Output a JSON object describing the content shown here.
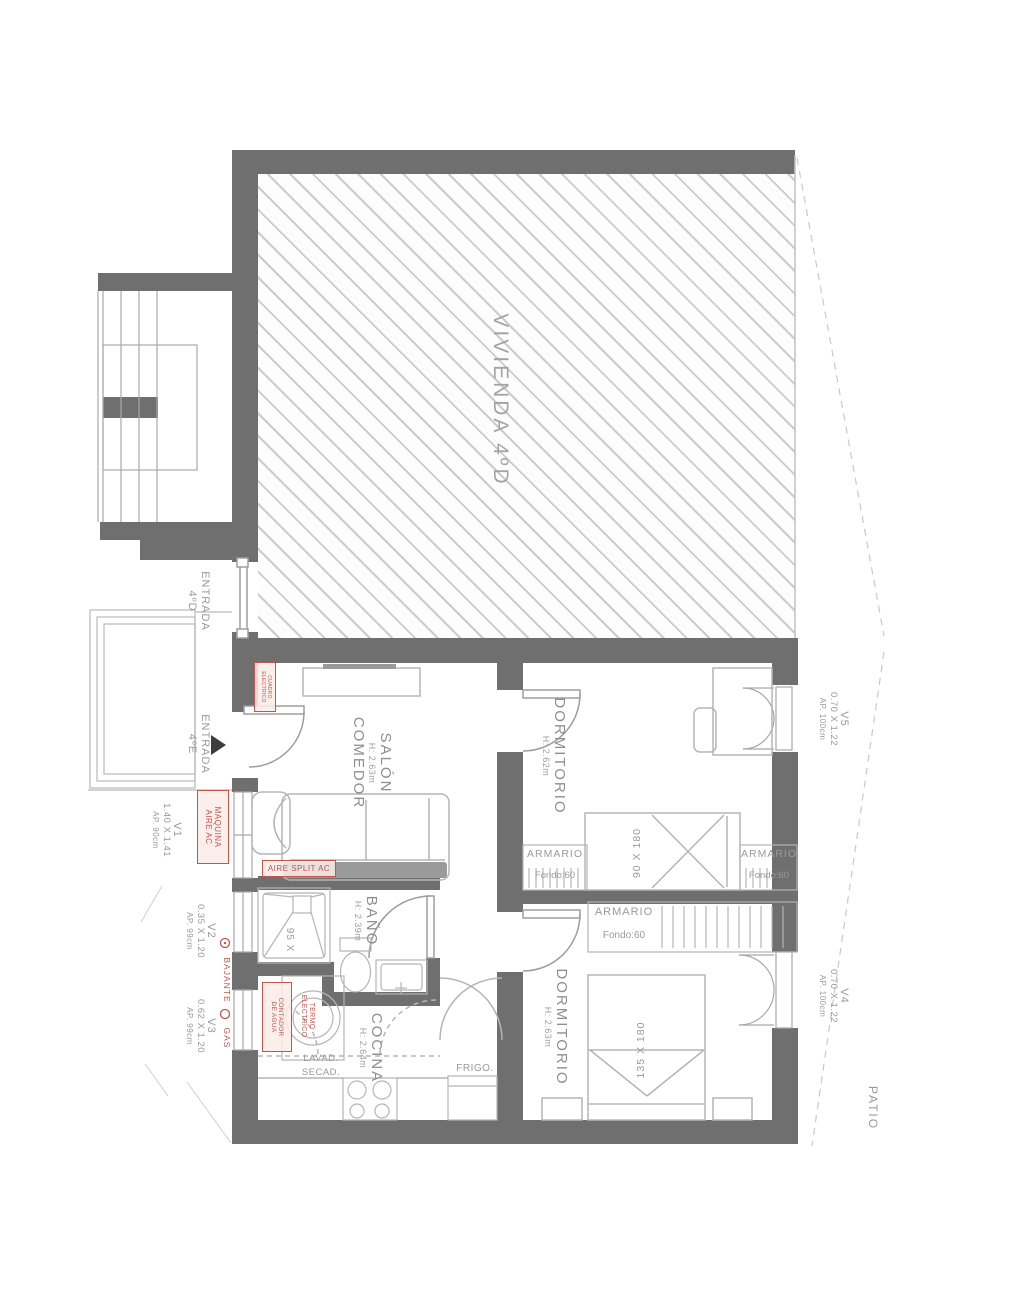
{
  "building": {
    "vivienda_label": "VIVIENDA 4ºD",
    "patio_label": "PATIO"
  },
  "entrances": {
    "d": {
      "line1": "ENTRADA",
      "line2": "4ºD"
    },
    "e": {
      "line1": "ENTRADA",
      "line2": "4ºE"
    }
  },
  "rooms": {
    "salon": {
      "line1": "SALÓN",
      "line2": "COMEDOR",
      "height": "H: 2.63m"
    },
    "dormitorio1": {
      "name": "DORMITORIO",
      "height": "H: 2.62m",
      "bed_size": "90 X 180"
    },
    "dormitorio2": {
      "name": "DORMITORIO",
      "height": "H: 2.63m",
      "bed_size": "135 X 180"
    },
    "bano": {
      "name": "BAÑO",
      "height": "H: 2.39m",
      "shower_size": "95 X"
    },
    "cocina": {
      "name": "COCINA",
      "height": "H: 2.64m"
    }
  },
  "wardrobes": {
    "bed1_left": {
      "name": "ARMARIO",
      "depth": "Fondo:60"
    },
    "bed1_right": {
      "name": "ARMARIO",
      "depth": "Fondo:60"
    },
    "bed2": {
      "name": "ARMARIO",
      "depth": "Fondo:60"
    }
  },
  "windows": {
    "v1": {
      "id": "V1",
      "size": "1.40 X 1.41",
      "sill": "AP. 90cm"
    },
    "v2": {
      "id": "V2",
      "size": "0.35 X 1.20",
      "sill": "AP. 99cm"
    },
    "v3": {
      "id": "V3",
      "size": "0.62 X 1.20",
      "sill": "AP. 99cm"
    },
    "v4": {
      "id": "V4",
      "size": "0.70 X 1.22",
      "sill": "AP. 100cm"
    },
    "v5": {
      "id": "V5",
      "size": "0.70 X 1.22",
      "sill": "AP. 100cm"
    }
  },
  "appliances": {
    "washer_line1": "LAVAD.",
    "washer_line2": "SECAD.",
    "fridge": "FRIGO."
  },
  "technical": {
    "cuadro_line1": "CUADRO",
    "cuadro_line2": "ELECTRICO",
    "maquina_line1": "MAQUINA",
    "maquina_line2": "AIRE AC",
    "aire_split": "AIRE SPLIT AC",
    "termo_line1": "TERMO",
    "termo_line2": "ELECTRICO",
    "contador_line1": "CONTADOR",
    "contador_line2": "DE AGUA",
    "bajante": "BAJANTE",
    "gas": "GAS"
  },
  "colors": {
    "wall": "#6f6f6f",
    "line": "#b5b5b5",
    "hatch": "#cbcbcb",
    "label": "#9a9a9a",
    "red": "#c0564e"
  }
}
